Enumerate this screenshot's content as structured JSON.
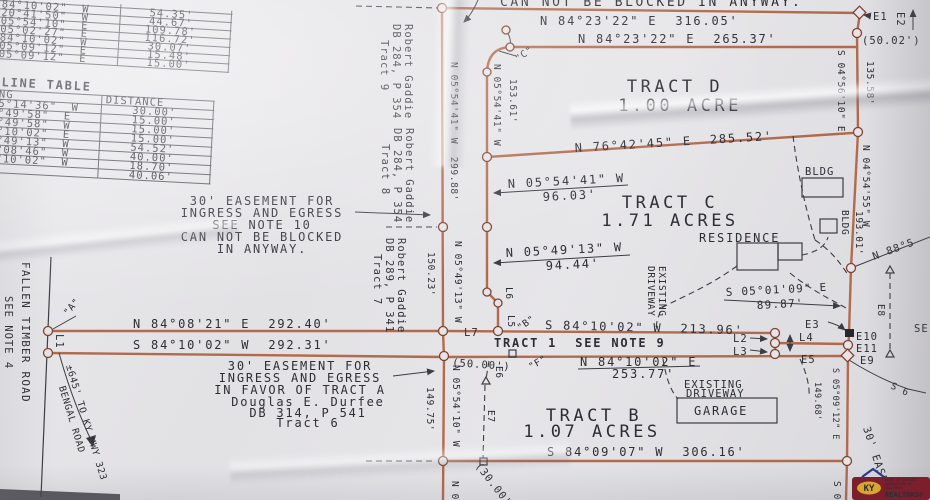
{
  "colors": {
    "plat_line": "#b26a4c",
    "ink": "#2d2d35",
    "paper": "#e2e1e4",
    "logo_maroon": "#7c1e2c",
    "logo_gold": "#d9a52e",
    "logo_blue": "#2b3a8c"
  },
  "survey_table": {
    "rows": [
      {
        "bearing": "84°10'02\"  W",
        "distance": "54.35'"
      },
      {
        "bearing": "20°41'50\"  W",
        "distance": "44.67'"
      },
      {
        "bearing": "05°54'10\"  E",
        "distance": "109.78'"
      },
      {
        "bearing": "05°02'27\"  E",
        "distance": "116.72'"
      },
      {
        "bearing": "84°10'02\"  W",
        "distance": "30.07'"
      },
      {
        "bearing": "05°09'12\"  E",
        "distance": "15.48'"
      },
      {
        "bearing": "05°09'12\"  E",
        "distance": "15.00'"
      }
    ]
  },
  "line_table": {
    "title": "LINE TABLE",
    "bearing_header": "NG",
    "distance_header": "DISTANCE",
    "rows": [
      {
        "bearing": "5°14'36\"  W",
        "distance": "30.00'"
      },
      {
        "bearing": "°49'58\"  E",
        "distance": "15.00'"
      },
      {
        "bearing": "°49'58\"  W",
        "distance": "15.00'"
      },
      {
        "bearing": "°10'02\"  E",
        "distance": "15.00'"
      },
      {
        "bearing": "°49'13\"  W",
        "distance": "54.52'"
      },
      {
        "bearing": "°08'46\"  W",
        "distance": "40.00'"
      },
      {
        "bearing": "°10'02\"  W",
        "distance": "18.70'"
      },
      {
        "bearing": "",
        "distance": "40.06'"
      }
    ]
  },
  "tracts": {
    "d_name": "TRACT D",
    "d_area": "1.00 ACRE",
    "c_name": "TRACT C",
    "c_area": "1.71 ACRES",
    "b_name": "TRACT B",
    "b_area": "1.07 ACRES",
    "t1": "TRACT 1  SEE NOTE 9"
  },
  "bearings": {
    "n842322a": "N 84°23'22\" E  316.05'",
    "n842322b": "N 84°23'22\" E  265.37'",
    "n764245": "N 76°42'45\" E  285.52'",
    "n055441a": "N 05°54'41\" W  299.88'",
    "n055441b": "N 05°54'41\" W",
    "d15361": "153.61'",
    "n055441c": "N 05°54'41\" W",
    "d9603": "96.03'",
    "n054913a": "N 05°49'13\" W",
    "d9444": "94.44'",
    "n054913b": "N 05°49'13\" W",
    "d15023": "150.23'",
    "s045610": "S 04°56'10\" E",
    "d13558": "135.58'",
    "n045455": "N 04°54'55\" W",
    "d19301": "193.01'",
    "s050109": "S 05°01'09\" E",
    "d8987": "89.87'",
    "s841002a": "S 84°10'02\" W  213.96'",
    "n841002": "N 84°10'02\" E",
    "d25377": "253.77'",
    "n840821": "N 84°08'21\" E  292.40'",
    "s841002b": "S 84°10'02\" W  292.31'",
    "s840907": "S 84°09'07\" W  306.16'",
    "n055410": "N 05°54'10\" W",
    "d14975": "149.75'",
    "s050912": "S 05°09'12\" E",
    "d14968": "149.68'"
  },
  "notes": {
    "blocked_top": "CAN NOT BE BLOCKED IN ANYWAY.",
    "e10": [
      "30' EASEMENT FOR",
      "INGRESS AND EGRESS",
      "SEE NOTE 10",
      "CAN NOT BE BLOCKED",
      "IN ANYWAY."
    ],
    "ea": [
      "30' EASEMENT FOR",
      "INGRESS AND EGRESS",
      "IN FAVOR OF TRACT A"
    ]
  },
  "owners": {
    "g9": [
      "Robert Gaddie",
      "DB 284, P 354",
      "Tract 9"
    ],
    "g8": [
      "Robert Gaddie",
      "DB 284, P 354",
      "Tract 8"
    ],
    "g7": [
      "Robert Gaddie",
      "DB 289, P 341",
      "Tract 7"
    ],
    "durfee": [
      "Douglas E. Durfee",
      "DB 314, P 541",
      "Tract 6"
    ]
  },
  "road": {
    "name": "FALLEN TIMBER ROAD",
    "note": "SEE NOTE 4",
    "hwy": [
      "±645' TO KY HWY 323",
      "BENGAL ROAD"
    ]
  },
  "buildings": {
    "residence": "RESIDENCE",
    "garage": "GARAGE",
    "bldg1": "BLDG",
    "bldg2": "BLDG",
    "driveway": [
      "EXISTING",
      "DRIVEWAY"
    ],
    "driveway_b": [
      "EXISTING",
      "DRIVEWAY"
    ]
  },
  "points": {
    "E1": "E1",
    "E2": "E2",
    "E3": "E3",
    "E5": "E5",
    "E6": "E6",
    "E7": "E7",
    "E8": "E8",
    "E9": "E9",
    "E10": "E10",
    "E11": "E11",
    "L1": "L1",
    "L2": "L2",
    "L3": "L3",
    "L4": "L4",
    "L5": "L5",
    "L6": "L6",
    "L7": "L7",
    "qA": "\"A\"",
    "qB": "\"B\"",
    "qC": "\"C\"",
    "qF": "\"F\""
  },
  "dims": {
    "p5002": "(50.02')",
    "p5000": "(50.00')",
    "p3000": "(30.00'",
    "ease30": "30' EASEM",
    "n885": "N 88°5",
    "s6": "S 6",
    "n0": "N 0",
    "s0": "S 0",
    "se": "SE"
  },
  "logo": {
    "monogram": "KY",
    "wordmark": "REALTORS®",
    "small_lines": [
      "HEART OF KENTUCKY",
      "ASSOCIATION OF",
      "REALTORS®"
    ]
  }
}
